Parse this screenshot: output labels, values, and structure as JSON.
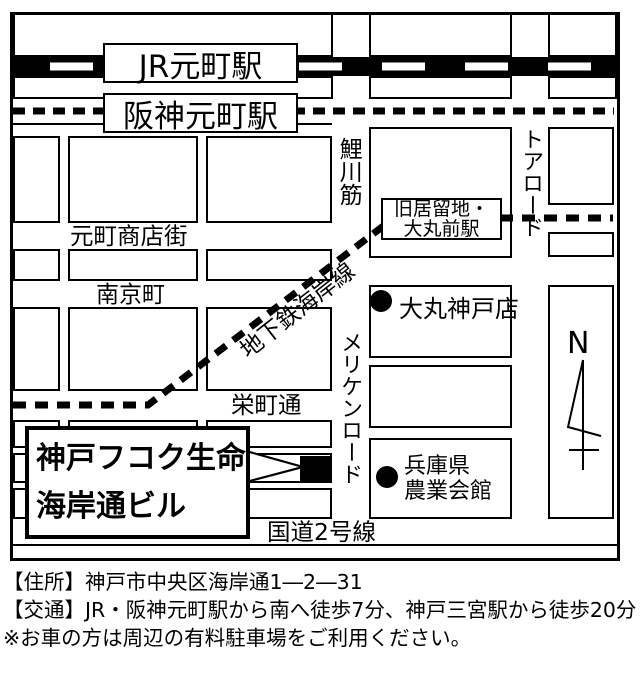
{
  "colors": {
    "ink": "#000000",
    "paper": "#ffffff"
  },
  "map": {
    "stations": {
      "jr": {
        "label": "JR元町駅"
      },
      "hanshin": {
        "label": "阪神元町駅"
      },
      "kyoryuchi": {
        "line1": "旧居留地・",
        "line2": "大丸前駅"
      }
    },
    "streets": {
      "koikawa": "鯉川筋",
      "tor": "トアロード",
      "meriken": "メリケンロード",
      "subway": "地下鉄海岸線",
      "motomachi_shopping": "元町商店街",
      "nankin": "南京町",
      "sakaemachi": "栄町通",
      "route2": "国道2号線"
    },
    "pois": {
      "daimaru": {
        "label": "大丸神戸店"
      },
      "agri": {
        "line1": "兵庫県",
        "line2": "農業会館"
      }
    },
    "destination": {
      "line1": "神戸フコク生命",
      "line2": "海岸通ビル"
    },
    "compass": {
      "label": "N"
    }
  },
  "footer": {
    "address": "【住所】神戸市中央区海岸通1―2―31",
    "access": "【交通】JR・阪神元町駅から南へ徒歩7分、神戸三宮駅から徒歩20分",
    "note": "※お車の方は周辺の有料駐車場をご利用ください。"
  }
}
